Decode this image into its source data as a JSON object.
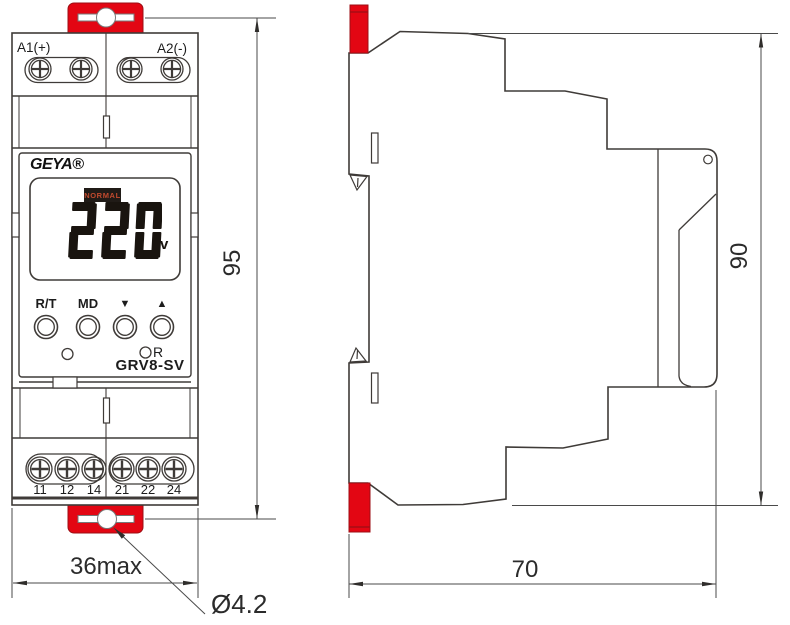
{
  "front_view": {
    "terminal_top": {
      "left_label": "A1(+)",
      "right_label": "A2(-)"
    },
    "brand": "GEYA®",
    "display": {
      "status": "NORMAL",
      "value": "220",
      "unit": "v"
    },
    "buttons": [
      {
        "label": "R/T"
      },
      {
        "label": "MD"
      },
      {
        "label": "▼"
      },
      {
        "label": "▲"
      }
    ],
    "reset_label": "R",
    "model": "GRV8-SV",
    "terminal_bottom": {
      "labels": [
        "11",
        "12",
        "14",
        "21",
        "22",
        "24"
      ]
    }
  },
  "dimensions": {
    "front_height": "95",
    "front_width": "36max",
    "hole_diameter": "Ø4.2",
    "side_height": "90",
    "side_depth": "70"
  },
  "colors": {
    "clip_red": "#e30613",
    "clip_edge": "#9c0f14",
    "line": "#3f3b38",
    "dim_line": "#4a4a4a",
    "digit": "#19140f",
    "status_bg": "#201b17",
    "status_text": "#c14a2e"
  }
}
